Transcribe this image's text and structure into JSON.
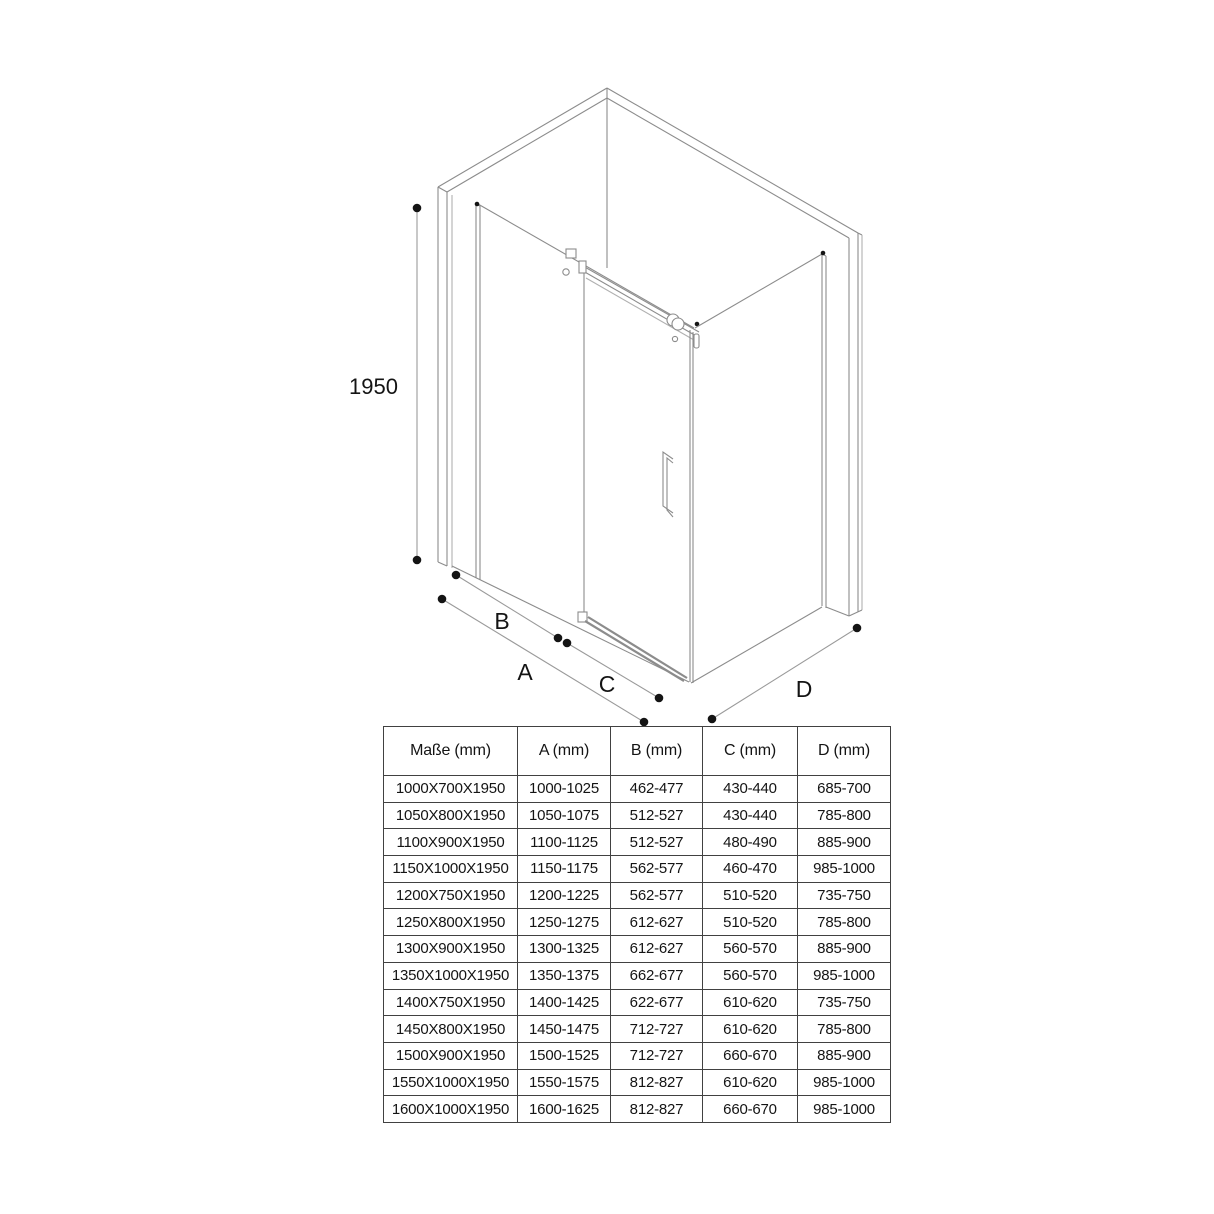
{
  "colors": {
    "line": "#8c8c8c",
    "line-light": "#b0b0b0",
    "dim": "#9a9a9a",
    "ink": "#141414",
    "border": "#414141"
  },
  "drawing": {
    "description": "isometric-shower-enclosure-technical-drawing",
    "height_dim": "1950",
    "dim_a": "A",
    "dim_b": "B",
    "dim_c": "C",
    "dim_d": "D"
  },
  "table": {
    "headers": {
      "m": "Maße (mm)",
      "a": "A (mm)",
      "b": "B (mm)",
      "c": "C (mm)",
      "d": "D (mm)"
    },
    "rows": [
      {
        "m": "1000X700X1950",
        "a": "1000-1025",
        "b": "462-477",
        "c": "430-440",
        "d": "685-700"
      },
      {
        "m": "1050X800X1950",
        "a": "1050-1075",
        "b": "512-527",
        "c": "430-440",
        "d": "785-800"
      },
      {
        "m": "1100X900X1950",
        "a": "1100-1125",
        "b": "512-527",
        "c": "480-490",
        "d": "885-900"
      },
      {
        "m": "1150X1000X1950",
        "a": "1150-1175",
        "b": "562-577",
        "c": "460-470",
        "d": "985-1000"
      },
      {
        "m": "1200X750X1950",
        "a": "1200-1225",
        "b": "562-577",
        "c": "510-520",
        "d": "735-750"
      },
      {
        "m": "1250X800X1950",
        "a": "1250-1275",
        "b": "612-627",
        "c": "510-520",
        "d": "785-800"
      },
      {
        "m": "1300X900X1950",
        "a": "1300-1325",
        "b": "612-627",
        "c": "560-570",
        "d": "885-900"
      },
      {
        "m": "1350X1000X1950",
        "a": "1350-1375",
        "b": "662-677",
        "c": "560-570",
        "d": "985-1000"
      },
      {
        "m": "1400X750X1950",
        "a": "1400-1425",
        "b": "622-677",
        "c": "610-620",
        "d": "735-750"
      },
      {
        "m": "1450X800X1950",
        "a": "1450-1475",
        "b": "712-727",
        "c": "610-620",
        "d": "785-800"
      },
      {
        "m": "1500X900X1950",
        "a": "1500-1525",
        "b": "712-727",
        "c": "660-670",
        "d": "885-900"
      },
      {
        "m": "1550X1000X1950",
        "a": "1550-1575",
        "b": "812-827",
        "c": "610-620",
        "d": "985-1000"
      },
      {
        "m": "1600X1000X1950",
        "a": "1600-1625",
        "b": "812-827",
        "c": "660-670",
        "d": "985-1000"
      }
    ]
  }
}
